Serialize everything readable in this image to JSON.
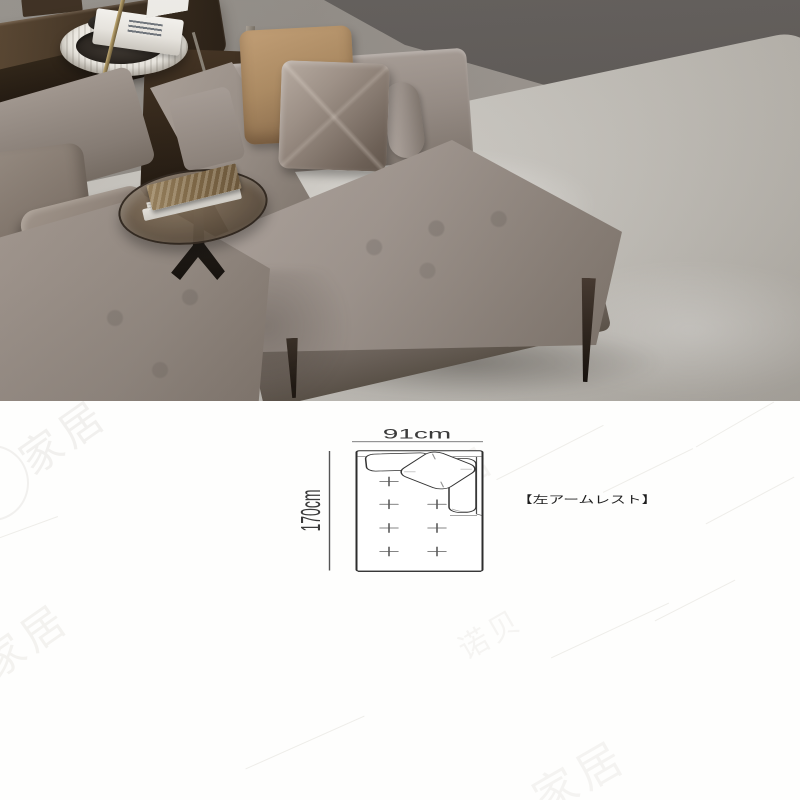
{
  "photo": {
    "palette": {
      "wall": "#5b5653",
      "floor": "#918c86",
      "rug": "#c6c3bd",
      "sofa_fabric": "#968c84",
      "pillow_tan": "#ab8960",
      "pillow_velvet": "#9c8f85",
      "console_wood": "#3a2c1d",
      "lamp_brass": "#9a8557",
      "table_glass": "#6f5f4c",
      "leg_wood": "#241c15"
    }
  },
  "diagram": {
    "width_label": "91cm",
    "height_label": "170cm",
    "caption": "【左アームレスト】",
    "line_color": "#3c3c3c",
    "tuft_mark_count": 7
  },
  "watermarks": [
    {
      "text": "家居"
    },
    {
      "text": "家居"
    },
    {
      "text": "居"
    },
    {
      "text": "诺贝"
    },
    {
      "text": "家居"
    }
  ]
}
